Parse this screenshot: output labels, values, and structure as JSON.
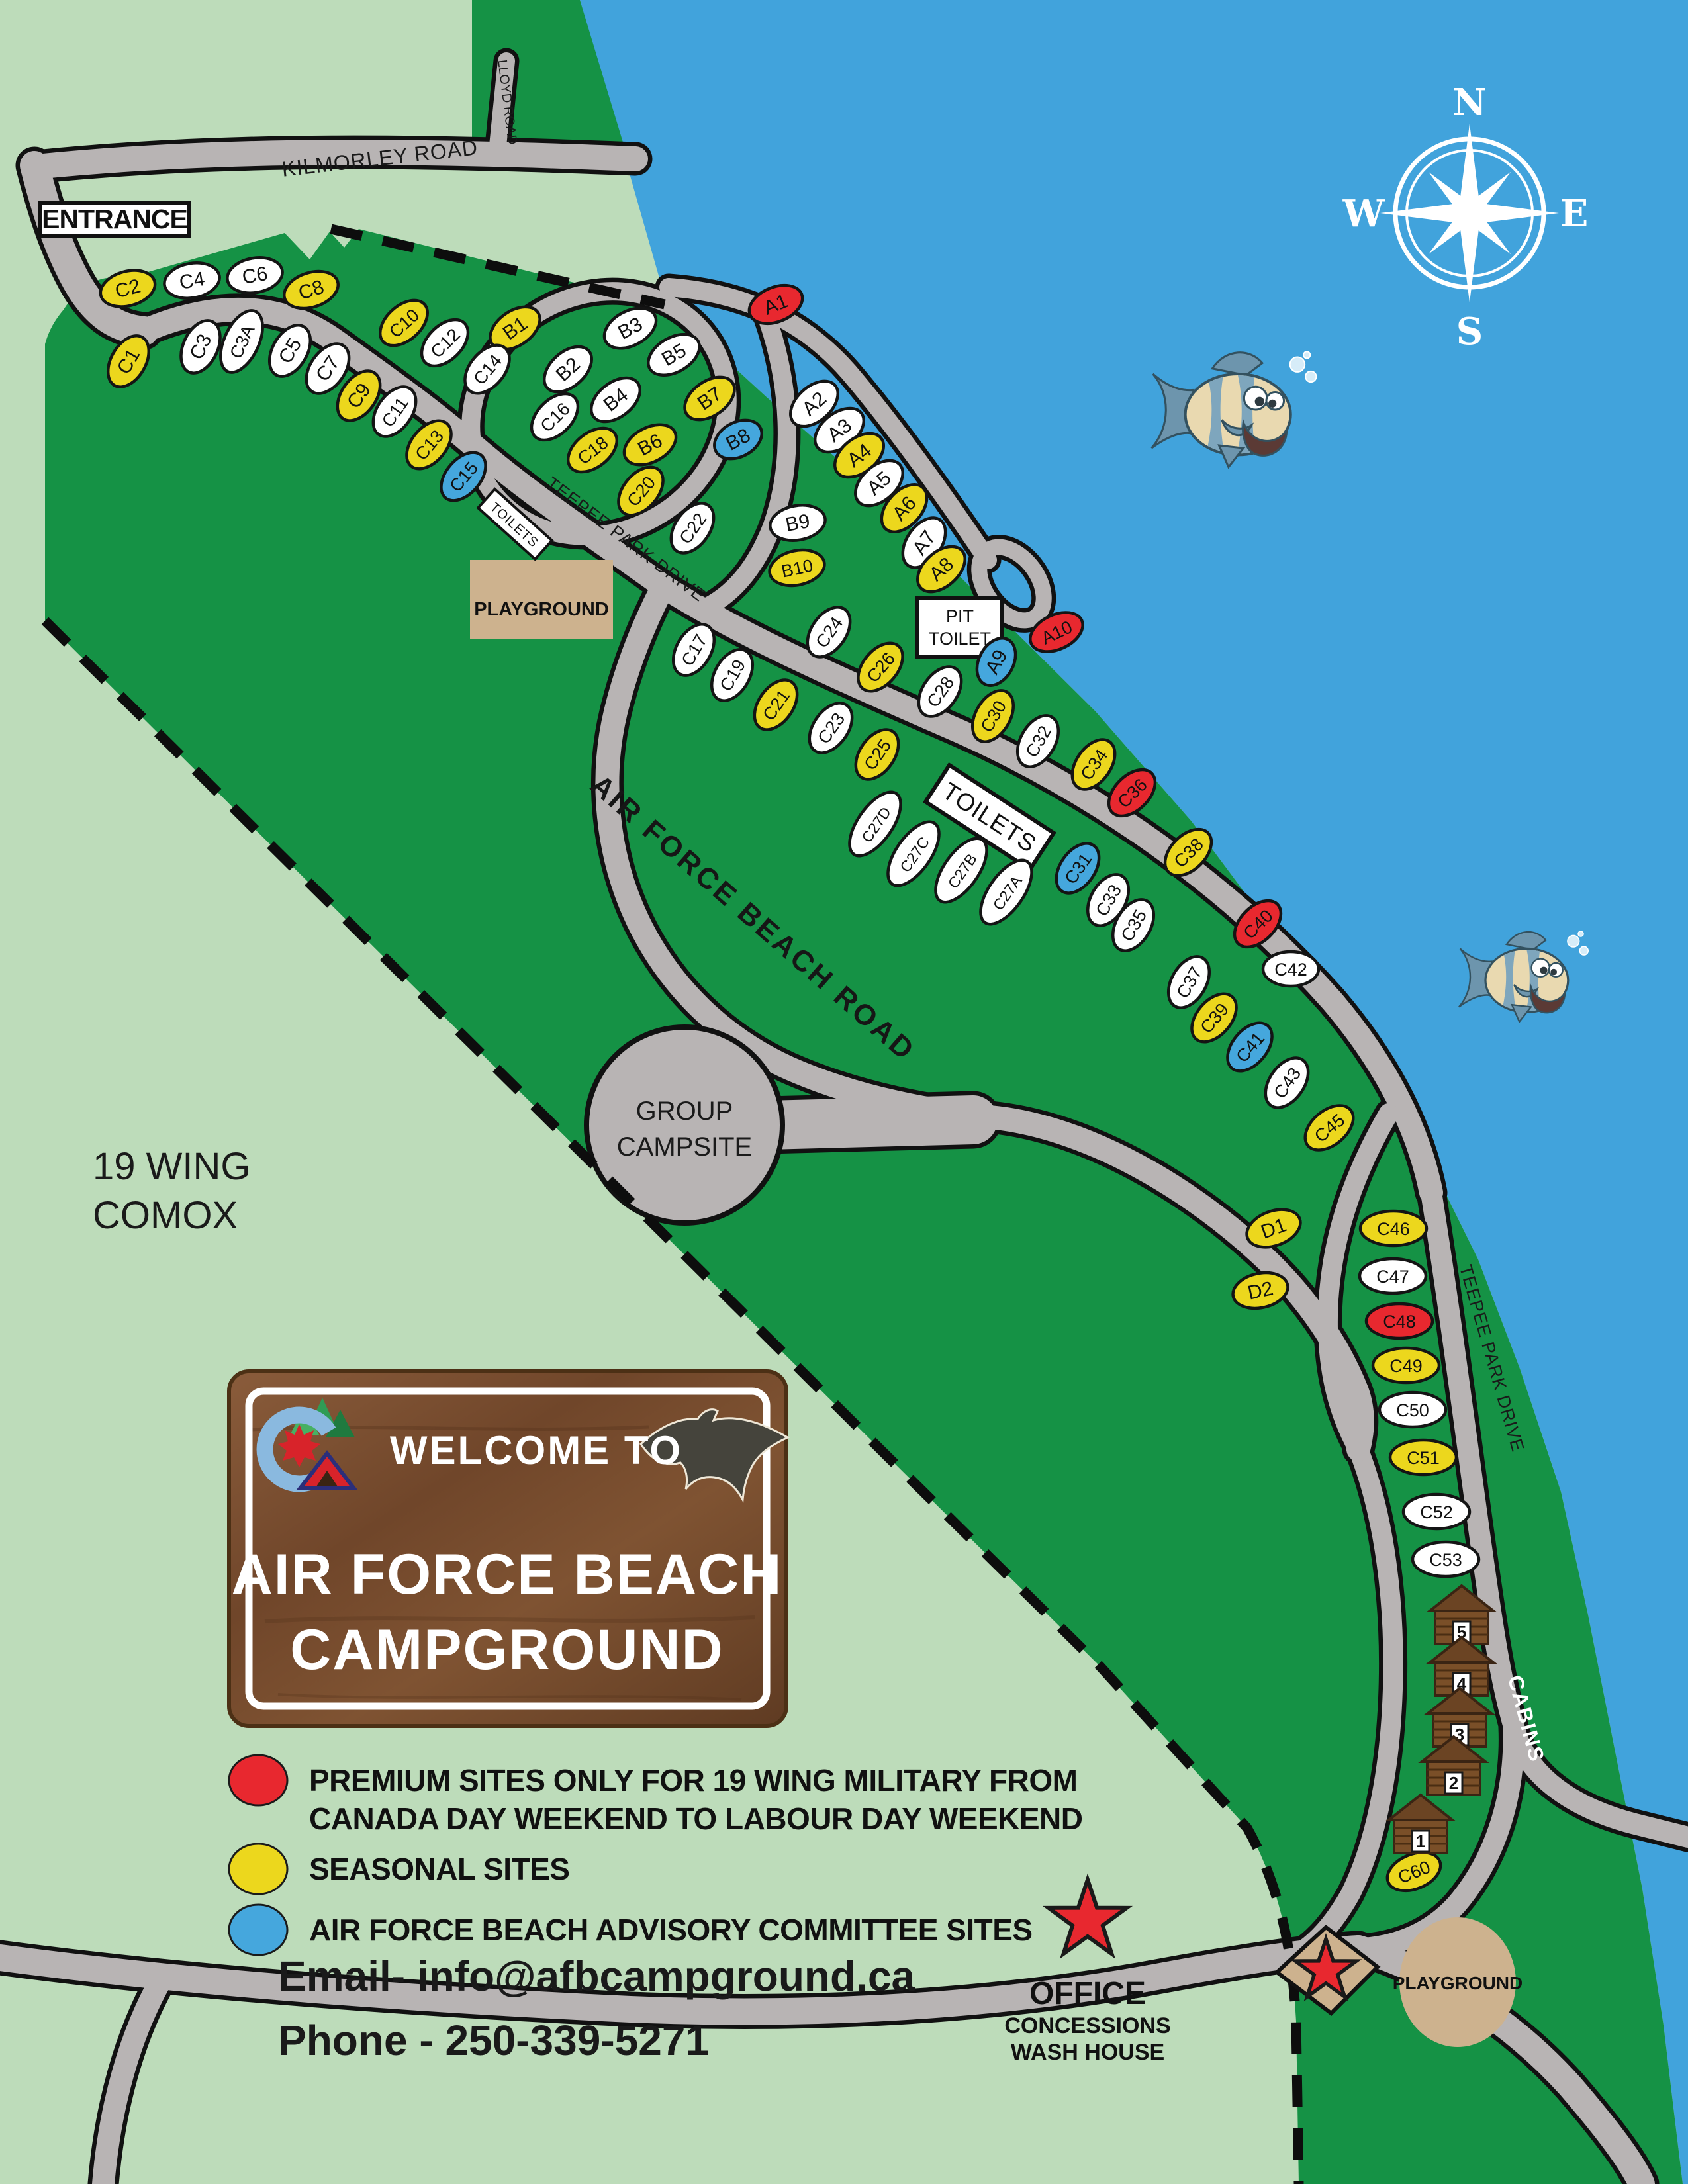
{
  "palette": {
    "bg": "#bddcba",
    "green": "#159245",
    "water": "#41a3dc",
    "road": "#b8b4b4",
    "tan": "#cdb28e",
    "seasonal": "#ecd71d",
    "premium": "#e8282f",
    "committee": "#45a7dd",
    "site_default": "#ffffff",
    "wood": "#7a5033",
    "cabin_brown": "#7a4f28"
  },
  "entrance": {
    "label": "ENTRANCE"
  },
  "roads": {
    "kilmorley": "KILMORLEY ROAD",
    "lloyd": "LLOYD ROAD",
    "teepee1": "TEEPEE PARK DRIVE",
    "teepee2": "TEEPEE PARK DRIVE",
    "afb": "AIR FORCE BEACH ROAD"
  },
  "areas": {
    "wing1": "19 WING",
    "wing2": "COMOX",
    "group1": "GROUP",
    "group2": "CAMPSITE",
    "playground_top": "PLAYGROUND",
    "playground_bottom": "PLAYGROUND"
  },
  "facilities": {
    "toilets_small": "TOILETS",
    "toilets_big": "TOILETS",
    "pit1": "PIT",
    "pit2": "TOILET"
  },
  "compass": {
    "n": "N",
    "e": "E",
    "s": "S",
    "w": "W"
  },
  "sign": {
    "welcome": "WELCOME TO",
    "title1": "AIR FORCE BEACH",
    "title2": "CAMPGROUND"
  },
  "legend": {
    "items": [
      {
        "key": "premium",
        "color": "#e8282f",
        "lines": [
          "PREMIUM SITES ONLY FOR 19 WING MILITARY FROM",
          "CANADA DAY WEEKEND TO LABOUR DAY WEEKEND"
        ]
      },
      {
        "key": "seasonal",
        "color": "#ecd71d",
        "lines": [
          "SEASONAL SITES"
        ]
      },
      {
        "key": "committee",
        "color": "#45a7dd",
        "lines": [
          "AIR FORCE BEACH ADVISORY COMMITTEE SITES"
        ]
      }
    ]
  },
  "contact": {
    "email": "Email- info@afbcampground.ca",
    "phone": "Phone - 250-339-5271"
  },
  "office": {
    "title": "OFFICE",
    "line2": "CONCESSIONS",
    "line3": "WASH HOUSE"
  },
  "cabins": {
    "label": "CABINS",
    "numbers": [
      "5",
      "4",
      "3",
      "2",
      "1"
    ]
  },
  "sites": [
    [
      "C2",
      193,
      436,
      "y",
      -15
    ],
    [
      "C4",
      290,
      424,
      "w",
      -10
    ],
    [
      "C6",
      385,
      416,
      "w",
      -10
    ],
    [
      "C8",
      470,
      438,
      "y",
      -18
    ],
    [
      "C10",
      610,
      488,
      "y",
      -42
    ],
    [
      "B1",
      778,
      496,
      "y",
      -35
    ],
    [
      "C12",
      672,
      518,
      "w",
      -45
    ],
    [
      "C14",
      736,
      558,
      "w",
      -50
    ],
    [
      "C1",
      194,
      546,
      "y",
      -60
    ],
    [
      "C3",
      303,
      524,
      "w",
      -65
    ],
    [
      "C3A",
      365,
      516,
      "w",
      -65,
      50
    ],
    [
      "C5",
      438,
      530,
      "w",
      -60
    ],
    [
      "C7",
      495,
      557,
      "w",
      -55
    ],
    [
      "C9",
      542,
      598,
      "y",
      -55
    ],
    [
      "C11",
      596,
      622,
      "w",
      -55
    ],
    [
      "C13",
      648,
      672,
      "y",
      -50
    ],
    [
      "C15",
      700,
      720,
      "b",
      -50
    ],
    [
      "B2",
      858,
      558,
      "w",
      -42
    ],
    [
      "B3",
      952,
      496,
      "w",
      -28
    ],
    [
      "B4",
      930,
      604,
      "w",
      -38
    ],
    [
      "B5",
      1018,
      536,
      "w",
      -30
    ],
    [
      "B6",
      982,
      672,
      "y",
      -28
    ],
    [
      "B7",
      1072,
      602,
      "y",
      -35
    ],
    [
      "B8",
      1115,
      664,
      "b",
      -28,
      38
    ],
    [
      "C16",
      838,
      630,
      "w",
      -45
    ],
    [
      "C18",
      895,
      680,
      "y",
      -38
    ],
    [
      "C20",
      968,
      742,
      "y",
      -50
    ],
    [
      "C22",
      1046,
      798,
      "w",
      -55
    ],
    [
      "A1",
      1172,
      460,
      "r",
      -22
    ],
    [
      "A2",
      1230,
      610,
      "w",
      -42
    ],
    [
      "A3",
      1268,
      650,
      "w",
      -38
    ],
    [
      "A4",
      1298,
      688,
      "y",
      -38
    ],
    [
      "A5",
      1328,
      730,
      "w",
      -42
    ],
    [
      "A6",
      1366,
      768,
      "y",
      -48
    ],
    [
      "A7",
      1396,
      820,
      "w",
      -55
    ],
    [
      "A8",
      1422,
      860,
      "y",
      -42
    ],
    [
      "A9",
      1505,
      1000,
      "b",
      -62,
      38
    ],
    [
      "A10",
      1596,
      955,
      "r",
      -25
    ],
    [
      "B9",
      1205,
      790,
      "w",
      -10
    ],
    [
      "B10",
      1204,
      858,
      "y",
      -12
    ],
    [
      "C24",
      1252,
      955,
      "w",
      -55
    ],
    [
      "C17",
      1048,
      982,
      "w",
      -60
    ],
    [
      "C19",
      1106,
      1020,
      "w",
      -60
    ],
    [
      "C21",
      1172,
      1065,
      "y",
      -55
    ],
    [
      "C23",
      1255,
      1100,
      "w",
      -55
    ],
    [
      "C25",
      1325,
      1140,
      "y",
      -55
    ],
    [
      "C26",
      1330,
      1008,
      "y",
      -50
    ],
    [
      "C28",
      1420,
      1045,
      "w",
      -55
    ],
    [
      "C30",
      1500,
      1082,
      "y",
      -60
    ],
    [
      "C32",
      1568,
      1120,
      "w",
      -60
    ],
    [
      "C34",
      1652,
      1155,
      "y",
      -55
    ],
    [
      "C36",
      1710,
      1198,
      "r",
      -45
    ],
    [
      "C38",
      1795,
      1288,
      "y",
      -45
    ],
    [
      "C27D",
      1322,
      1245,
      "w",
      -55,
      56
    ],
    [
      "C27C",
      1380,
      1290,
      "w",
      -55,
      56
    ],
    [
      "C27B",
      1452,
      1315,
      "w",
      -55,
      56
    ],
    [
      "C27A",
      1520,
      1348,
      "w",
      -55,
      56
    ],
    [
      "C31",
      1628,
      1312,
      "b",
      -55
    ],
    [
      "C33",
      1674,
      1360,
      "w",
      -60
    ],
    [
      "C35",
      1712,
      1398,
      "w",
      -60
    ],
    [
      "C37",
      1796,
      1484,
      "w",
      -60
    ],
    [
      "C39",
      1834,
      1538,
      "y",
      -50
    ],
    [
      "C40",
      1900,
      1396,
      "r",
      -45
    ],
    [
      "C41",
      1888,
      1582,
      "b",
      -50
    ],
    [
      "C42",
      1950,
      1464,
      "w",
      0
    ],
    [
      "C43",
      1944,
      1636,
      "w",
      -55
    ],
    [
      "C45",
      2008,
      1704,
      "y",
      -40
    ],
    [
      "D1",
      1924,
      1856,
      "y",
      -20
    ],
    [
      "D2",
      1904,
      1950,
      "y",
      -12
    ],
    [
      "C46",
      2105,
      1856,
      "y",
      0,
      50
    ],
    [
      "C47",
      2104,
      1928,
      "w",
      0,
      50
    ],
    [
      "C48",
      2114,
      1996,
      "r",
      0,
      50
    ],
    [
      "C49",
      2124,
      2063,
      "y",
      0,
      50
    ],
    [
      "C50",
      2134,
      2130,
      "w",
      0,
      50
    ],
    [
      "C51",
      2150,
      2202,
      "y",
      0,
      50
    ],
    [
      "C52",
      2170,
      2284,
      "w",
      0,
      50
    ],
    [
      "C53",
      2184,
      2356,
      "w",
      0,
      50
    ],
    [
      "C60",
      2136,
      2828,
      "y",
      -22
    ]
  ]
}
